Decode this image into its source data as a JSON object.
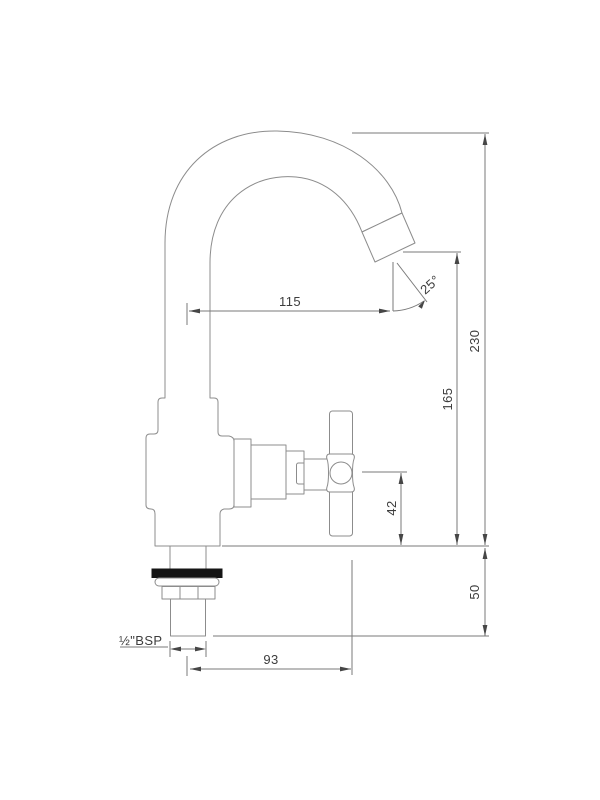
{
  "drawing": {
    "kind": "faucet-technical-drawing",
    "description": "Dimensioned line drawing of a single-hole pillar tap with swan-neck spout and cross handle",
    "colors": {
      "background": "#ffffff",
      "line": "#8c8c8c",
      "dimension_line": "#7a7a7a",
      "text": "#3d3d3d",
      "washer": "#151515"
    },
    "dimensions": {
      "spout_reach": "115",
      "outlet_angle": "25°",
      "total_height": "230",
      "outlet_height": "165",
      "handle_center_height": "42",
      "below_deck_depth": "50",
      "handle_offset": "93",
      "inlet_thread": "½\"BSP"
    }
  }
}
